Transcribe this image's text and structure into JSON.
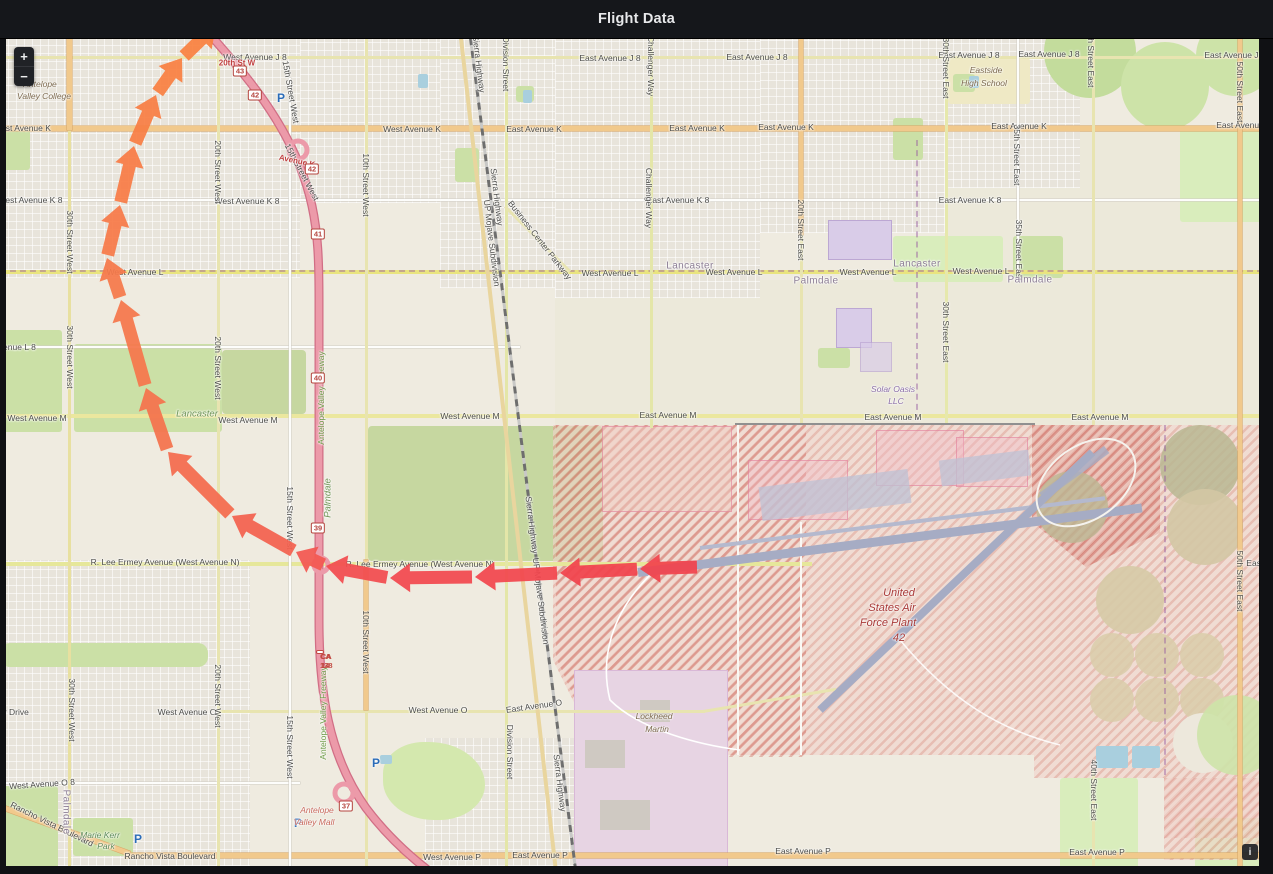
{
  "panel": {
    "title": "Flight Data"
  },
  "map_controls": {
    "zoom_in": "+",
    "zoom_out": "−"
  },
  "attribution": {
    "info": "i"
  },
  "map": {
    "parking_glyph": "P",
    "labels": [
      {
        "t": "West Avenue J 8",
        "x": 255,
        "y": 57
      },
      {
        "t": "East Avenue J 8",
        "x": 610,
        "y": 58
      },
      {
        "t": "East Avenue J 8",
        "x": 757,
        "y": 57
      },
      {
        "t": "East Avenue J 8",
        "x": 969,
        "y": 55
      },
      {
        "t": "East Avenue J 8",
        "x": 1049,
        "y": 54
      },
      {
        "t": "East Avenue J 8",
        "x": 1235,
        "y": 55
      },
      {
        "t": "West Avenue K",
        "x": 22,
        "y": 128
      },
      {
        "t": "West Avenue K",
        "x": 412,
        "y": 129
      },
      {
        "t": "East Avenue K",
        "x": 534,
        "y": 129
      },
      {
        "t": "East Avenue K",
        "x": 697,
        "y": 128
      },
      {
        "t": "East Avenue K",
        "x": 786,
        "y": 127
      },
      {
        "t": "East Avenue K",
        "x": 1019,
        "y": 126
      },
      {
        "t": "East Avenue K",
        "x": 1244,
        "y": 125
      },
      {
        "t": "West Avenue K 8",
        "x": 30,
        "y": 200
      },
      {
        "t": "West Avenue K 8",
        "x": 247,
        "y": 201
      },
      {
        "t": "East Avenue K 8",
        "x": 678,
        "y": 200
      },
      {
        "t": "East Avenue K 8",
        "x": 970,
        "y": 200
      },
      {
        "t": "West Avenue L",
        "x": 135,
        "y": 272
      },
      {
        "t": "West Avenue L",
        "x": 610,
        "y": 273
      },
      {
        "t": "West Avenue L",
        "x": 734,
        "y": 272
      },
      {
        "t": "West Avenue L",
        "x": 868,
        "y": 272
      },
      {
        "t": "West Avenue L",
        "x": 981,
        "y": 271
      },
      {
        "t": "West Avenue L 8",
        "x": 4,
        "y": 347
      },
      {
        "t": "West Avenue M",
        "x": 37,
        "y": 418
      },
      {
        "t": "West Avenue M",
        "x": 248,
        "y": 420
      },
      {
        "t": "West Avenue M",
        "x": 470,
        "y": 416
      },
      {
        "t": "East Avenue M",
        "x": 668,
        "y": 415
      },
      {
        "t": "East Avenue M",
        "x": 893,
        "y": 417
      },
      {
        "t": "East Avenue M",
        "x": 1100,
        "y": 417
      },
      {
        "t": "R. Lee Ermey Avenue (West Avenue N)",
        "x": 165,
        "y": 562
      },
      {
        "t": "R. Lee Ermey Avenue (West Avenue N)",
        "x": 420,
        "y": 564
      },
      {
        "t": "West Avenue O",
        "x": 187,
        "y": 712
      },
      {
        "t": "West Avenue O",
        "x": 438,
        "y": 710
      },
      {
        "t": "East Avenue O",
        "x": 534,
        "y": 706,
        "r": -8
      },
      {
        "t": "West Avenue O 8",
        "x": 42,
        "y": 784,
        "r": -4
      },
      {
        "t": "er Drive",
        "x": 14,
        "y": 712
      },
      {
        "t": "Rancho Vista Boulevard",
        "x": 52,
        "y": 824,
        "r": 26
      },
      {
        "t": "Rancho Vista Boulevard",
        "x": 170,
        "y": 856
      },
      {
        "t": "West Avenue P",
        "x": 452,
        "y": 857
      },
      {
        "t": "East Avenue P",
        "x": 540,
        "y": 855
      },
      {
        "t": "East Avenue P",
        "x": 803,
        "y": 851
      },
      {
        "t": "East Avenue P",
        "x": 1097,
        "y": 852
      },
      {
        "t": "East Ave",
        "x": 1263,
        "y": 563
      },
      {
        "t": "30th Street West",
        "x": 70,
        "y": 242,
        "r": 90
      },
      {
        "t": "30th Street West",
        "x": 70,
        "y": 357,
        "r": 90
      },
      {
        "t": "30th Street West",
        "x": 72,
        "y": 710,
        "r": 90
      },
      {
        "t": "20th Street West",
        "x": 218,
        "y": 172,
        "r": 90
      },
      {
        "t": "20th Street West",
        "x": 218,
        "y": 368,
        "r": 90
      },
      {
        "t": "20th Street West",
        "x": 218,
        "y": 696,
        "r": 90
      },
      {
        "t": "15th Street West",
        "x": 291,
        "y": 92,
        "r": 80
      },
      {
        "t": "15th Street West",
        "x": 302,
        "y": 172,
        "r": 62
      },
      {
        "t": "15th Street West",
        "x": 290,
        "y": 518,
        "r": 90
      },
      {
        "t": "15th Street West",
        "x": 290,
        "y": 747,
        "r": 90
      },
      {
        "t": "10th Street West",
        "x": 366,
        "y": 185,
        "r": 90
      },
      {
        "t": "10th Street West",
        "x": 366,
        "y": 642,
        "r": 90
      },
      {
        "t": "Division Street",
        "x": 506,
        "y": 64,
        "r": 90
      },
      {
        "t": "Division Street",
        "x": 510,
        "y": 752,
        "r": 90
      },
      {
        "t": "Challenger Way",
        "x": 651,
        "y": 66,
        "r": 90
      },
      {
        "t": "Challenger Way",
        "x": 649,
        "y": 198,
        "r": 90
      },
      {
        "t": "Sierra Highway",
        "x": 479,
        "y": 64,
        "r": 83
      },
      {
        "t": "Sierra Highway",
        "x": 497,
        "y": 197,
        "r": 83
      },
      {
        "t": "Sierra Highway",
        "x": 532,
        "y": 525,
        "r": 83
      },
      {
        "t": "Sierra Highway",
        "x": 560,
        "y": 783,
        "r": 83
      },
      {
        "t": "UP Mojave Subdivision",
        "x": 492,
        "y": 243,
        "r": 83
      },
      {
        "t": "UP Mojave Subdivision",
        "x": 541,
        "y": 601,
        "r": 83
      },
      {
        "t": "Business Center Parkway",
        "x": 540,
        "y": 240,
        "r": 52
      },
      {
        "t": "Antelope Valley Freeway",
        "x": 321,
        "y": 398,
        "r": -90,
        "c": "st-green"
      },
      {
        "t": "Antelope Valley Freeway",
        "x": 323,
        "y": 713,
        "r": -90,
        "c": "st-green"
      },
      {
        "t": "20th Street East",
        "x": 801,
        "y": 230,
        "r": 90
      },
      {
        "t": "30th Street East",
        "x": 946,
        "y": 68,
        "r": 90
      },
      {
        "t": "30th Street East",
        "x": 946,
        "y": 332,
        "r": 90
      },
      {
        "t": "35th Street East",
        "x": 1017,
        "y": 155,
        "r": 90
      },
      {
        "t": "35th Street East",
        "x": 1019,
        "y": 250,
        "r": 90
      },
      {
        "t": "40th Street East",
        "x": 1091,
        "y": 57,
        "r": 90
      },
      {
        "t": "40th Street East",
        "x": 1094,
        "y": 790,
        "r": 90
      },
      {
        "t": "50th Street East",
        "x": 1240,
        "y": 92,
        "r": 90
      },
      {
        "t": "50th Street East",
        "x": 1240,
        "y": 581,
        "r": 90
      },
      {
        "t": "Lancaster",
        "x": 690,
        "y": 266,
        "c": "city"
      },
      {
        "t": "Lancaster",
        "x": 917,
        "y": 264,
        "c": "city"
      },
      {
        "t": "Palmdale",
        "x": 816,
        "y": 281,
        "c": "city"
      },
      {
        "t": "Palmdale",
        "x": 1030,
        "y": 280,
        "c": "city"
      },
      {
        "t": "Palmdale",
        "x": 66,
        "y": 812,
        "r": 90,
        "c": "city"
      },
      {
        "t": "Lancaster",
        "x": 197,
        "y": 414,
        "c": "city-green"
      },
      {
        "t": "Palmdale",
        "x": 328,
        "y": 498,
        "r": -90,
        "c": "city-green"
      },
      {
        "t": "Antelope",
        "x": 40,
        "y": 84,
        "c": "poi-brown"
      },
      {
        "t": "Valley College",
        "x": 44,
        "y": 96,
        "c": "poi-brown"
      },
      {
        "t": "Eastside",
        "x": 986,
        "y": 70,
        "c": "poi-brown"
      },
      {
        "t": "High School",
        "x": 984,
        "y": 83,
        "c": "poi-brown"
      },
      {
        "t": "Solar Oasis",
        "x": 893,
        "y": 389,
        "c": "poi-purple"
      },
      {
        "t": "LLC",
        "x": 896,
        "y": 401,
        "c": "poi-purple"
      },
      {
        "t": "Lockheed",
        "x": 654,
        "y": 716,
        "c": "poi-brown"
      },
      {
        "t": "Martin",
        "x": 657,
        "y": 729,
        "c": "poi-brown"
      },
      {
        "t": "Antelope",
        "x": 317,
        "y": 810,
        "c": "poi-red"
      },
      {
        "t": "Valley Mall",
        "x": 314,
        "y": 822,
        "c": "poi-red"
      },
      {
        "t": "United",
        "x": 899,
        "y": 593,
        "c": "poi-red2"
      },
      {
        "t": "States Air",
        "x": 892,
        "y": 608,
        "c": "poi-red2"
      },
      {
        "t": "Force Plant",
        "x": 888,
        "y": 623,
        "c": "poi-red2"
      },
      {
        "t": "42",
        "x": 899,
        "y": 638,
        "c": "poi-red2"
      },
      {
        "t": "Marie Kerr",
        "x": 100,
        "y": 835,
        "c": "poi-green"
      },
      {
        "t": "Park",
        "x": 106,
        "y": 846,
        "c": "poi-green"
      },
      {
        "t": "20th St W",
        "x": 237,
        "y": 63,
        "c": "exit-red"
      },
      {
        "t": "Avenue K",
        "x": 297,
        "y": 161,
        "r": 12,
        "c": "exit-red"
      }
    ],
    "shields": [
      {
        "t": "43",
        "x": 240,
        "y": 71
      },
      {
        "t": "42",
        "x": 255,
        "y": 95
      },
      {
        "t": "42",
        "x": 312,
        "y": 169
      },
      {
        "t": "41",
        "x": 318,
        "y": 234
      },
      {
        "t": "40",
        "x": 318,
        "y": 378
      },
      {
        "t": "39",
        "x": 318,
        "y": 528
      },
      {
        "t": "37",
        "x": 346,
        "y": 806
      }
    ],
    "ca_shield": {
      "lines": [
        "CA 14",
        "CA 138"
      ],
      "x": 320,
      "y": 652
    },
    "parking": [
      [
        281,
        98
      ],
      [
        376,
        763
      ],
      [
        298,
        823
      ],
      [
        138,
        839
      ]
    ],
    "flight_path": {
      "description": "Flight track departing USAF Plant 42 runway heading west along West Avenue N, arcing north over west Lancaster and exiting the top of the map",
      "points": [
        [
          697,
          567
        ],
        [
          640,
          569
        ],
        [
          560,
          573
        ],
        [
          475,
          577
        ],
        [
          390,
          578
        ],
        [
          326,
          566
        ],
        [
          296,
          552
        ],
        [
          232,
          516
        ],
        [
          168,
          452
        ],
        [
          146,
          388
        ],
        [
          121,
          300
        ],
        [
          107,
          258
        ],
        [
          120,
          205
        ],
        [
          134,
          146
        ],
        [
          156,
          95
        ],
        [
          182,
          58
        ],
        [
          216,
          25
        ]
      ],
      "segment_colors": [
        "#F1434C",
        "#F1434C",
        "#F2464E",
        "#F2484F",
        "#F24B4F",
        "#F35751",
        "#F3614F",
        "#F46A4E",
        "#F4724C",
        "#F5764B",
        "#F5784A",
        "#F67A48",
        "#F77C46",
        "#F87E44",
        "#F98042",
        "#F98140"
      ]
    }
  }
}
